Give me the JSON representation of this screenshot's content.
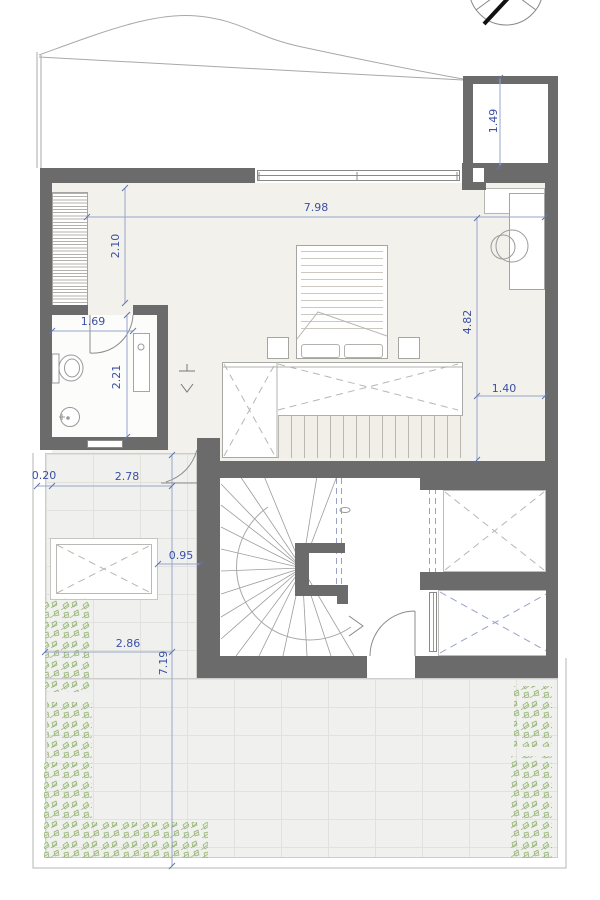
{
  "drawing": {
    "type": "architectural floor plan",
    "compass_icon": "north-arrow-icon"
  },
  "dims": {
    "shaft_depth": "1.49",
    "bedroom_width": "7.98",
    "closet_span": "2.10",
    "bath_width": "1.69",
    "bath_depth": "2.21",
    "bedroom_depth": "4.82",
    "void_to_wall": "1.40",
    "parapet_width": "0.20",
    "terrace_top_width": "2.78",
    "skylight_gap": "0.95",
    "terrace_width": "2.86",
    "terrace_depth": "7.19"
  },
  "colors": {
    "wall": "#6b6b6b",
    "bedroom_floor": "#f2f1ec",
    "terrace_tile": "#f0f0ee",
    "dimension_text": "#3a50a4",
    "dimension_line": "#96a6cc",
    "void_dash": "#b6b6b4",
    "blue_dash": "#98a2c8",
    "plant_green": "#8fae72"
  }
}
